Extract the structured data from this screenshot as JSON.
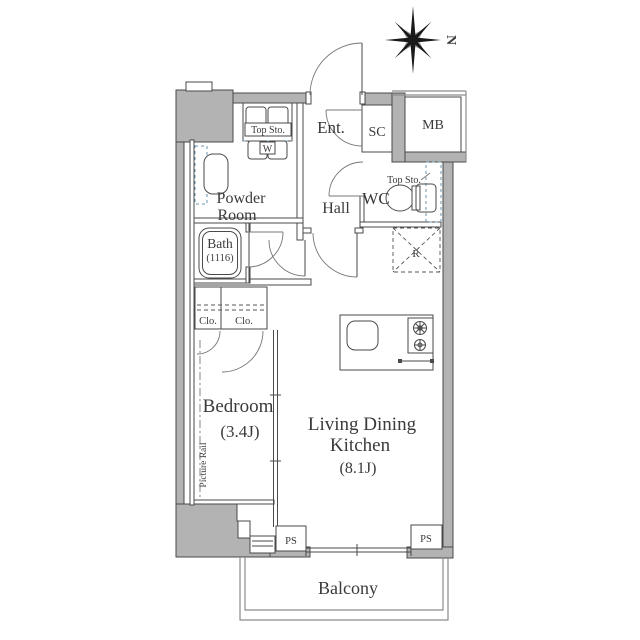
{
  "compass": {
    "north_label": "N"
  },
  "rooms": {
    "entrance": {
      "label": "Ent."
    },
    "shoe_closet": {
      "label": "SC"
    },
    "meter_box": {
      "label": "MB"
    },
    "hall": {
      "label": "Hall"
    },
    "wc": {
      "label": "WC"
    },
    "powder_room": {
      "line1": "Powder",
      "line2": "Room"
    },
    "bath": {
      "line1": "Bath",
      "line2": "(1116)"
    },
    "bedroom": {
      "line1": "Bedroom",
      "line2": "(3.4J)"
    },
    "ldk": {
      "line1": "Living Dining",
      "line2": "Kitchen",
      "line3": "(8.1J)"
    },
    "balcony": {
      "label": "Balcony"
    }
  },
  "fixtures": {
    "top_storage_laundry": "Top Sto.",
    "washer": "W",
    "top_storage_wc": "Top Sto.",
    "refrigerator": "R",
    "closet_left": "Clo.",
    "closet_right": "Clo.",
    "picture_rail": "Picture Rail",
    "pipe_shaft_left": "PS",
    "pipe_shaft_right": "PS"
  },
  "colors": {
    "wet_area": "#cde4f1",
    "wall_fill": "#b3b3b3",
    "line": "#4a4a4a",
    "background": "#ffffff"
  }
}
